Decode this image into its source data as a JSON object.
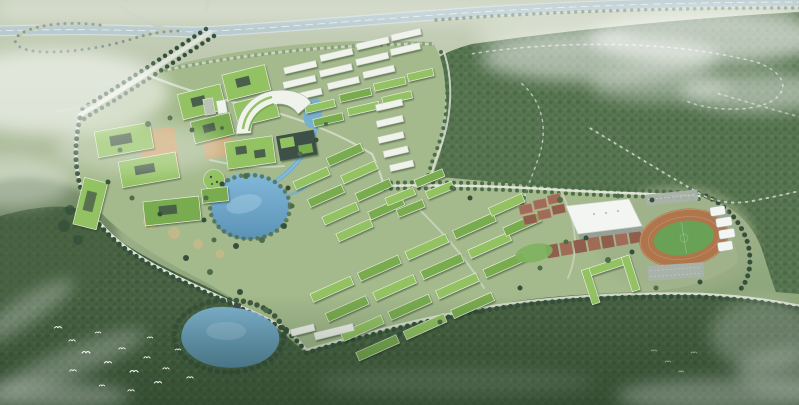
{
  "scene": {
    "type": "aerial-architectural-rendering",
    "setting": "Bird's-eye rendering of a green university campus masterplan surrounded by forest parkland and hazy farmland, with low clouds drifting over the site",
    "features": [
      "elevated expressway crossing the top with a cloverleaf loop ramp at the top-left",
      "tree-lined entrance boulevard running from the expressway junction to the campus",
      "academic quarter of green-roofed courtyard buildings in the north-west",
      "crescent-shaped white library building beside a pond",
      "rows of white mid-rise housing blocks in the north",
      "tan central plazas and circular playgrounds",
      "campus lake fed by a winding water channel",
      "diagonal rows of dormitory slabs with planted green roofs",
      "U-shaped dormitory court",
      "red sports courts and parking strips",
      "white-roofed gymnasium",
      "stadium with orange running track, green pitch and white canopy grandstand",
      "tree-lined loop roads curving through the forest park on the right",
      "southern boundary road lined with regularly spaced trees",
      "natural lake in the southern woodland with a small pavilion",
      "flocks of white birds over the south-west woods",
      "white mist banks over the top-right forest and the corners"
    ]
  },
  "colors": {
    "fieldTop": "#c8d1bc",
    "fieldMid": "#a0b48c",
    "fieldLow": "#7e9a6e",
    "campusGround": "#a4b98c",
    "sportsGround": "#9eae89",
    "forest": "#577550",
    "forestDark": "#486243",
    "forestDeep": "#334c33",
    "treeDark": "#35503a",
    "treeMid": "#4d6d49",
    "roofGreen": "#93c263",
    "roofGreenDeep": "#79ab50",
    "roofDark": "#3e4f47",
    "bldgWhite": "#f0f3ec",
    "bldgWall": "#b9c3b4",
    "plaza": "#d2a874",
    "sand": "#c9b98a",
    "water": "#74aed2",
    "waterDeep": "#5b93b6",
    "waterEdge": "#a8d4e8",
    "road": "#c3cbbd",
    "roadLight": "#dfe4d8",
    "highway": "#b7cace",
    "highwayEdge": "#d3dedf",
    "track": "#b0764b",
    "pitch": "#69a156",
    "pitchLight": "#7db35e",
    "court": "#a06c58",
    "courtAlt": "#8f5e4d",
    "parking": "#a9b2a9",
    "canopy": "#f2f5f1",
    "gymShadow": "#96a096",
    "mist": "#ffffff",
    "bird": "#ffffff"
  }
}
